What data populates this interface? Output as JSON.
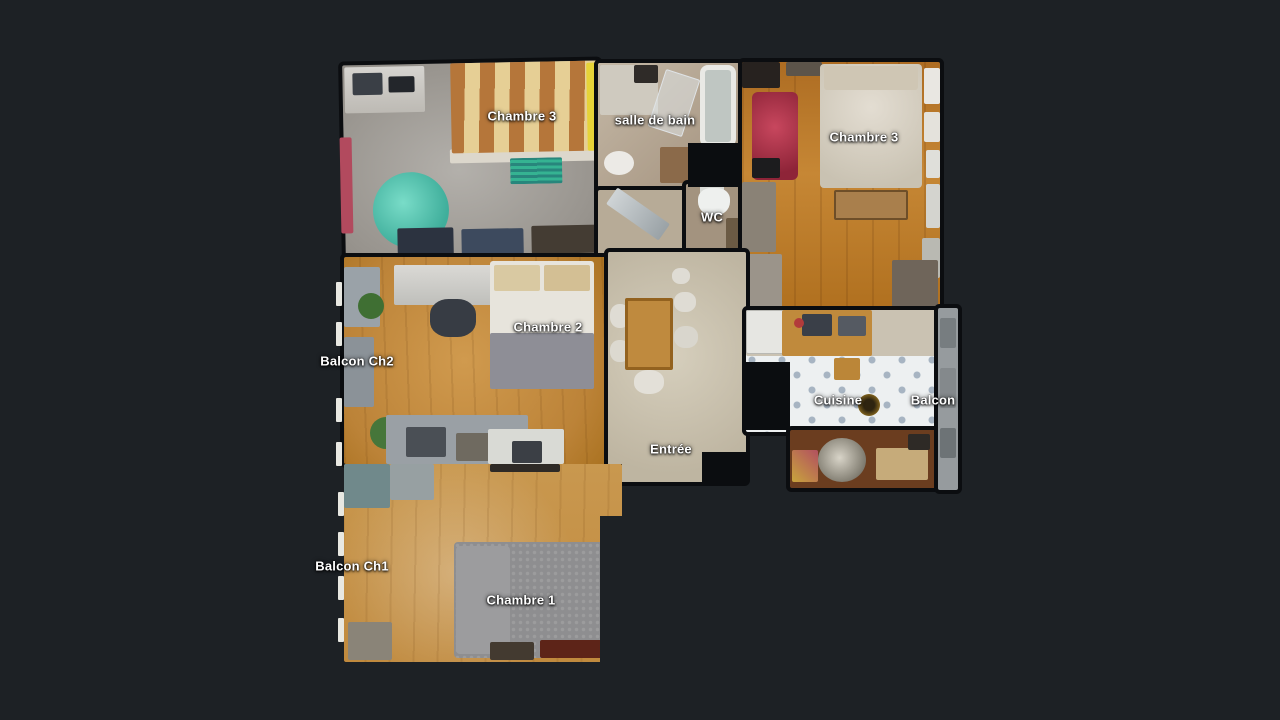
{
  "scene": {
    "kind": "apartment-floorplan-top-view",
    "background": "#1d2125"
  },
  "palette": {
    "background": "#1d2125",
    "label_text": "#ffffff",
    "wood_floor": "#c08136",
    "grey_floor": "#9b9894",
    "tile_floor": "#edf0f1",
    "hall_floor": "#cec6b4",
    "accent_teal": "#4ecdb4",
    "wall": "#0b0d10"
  },
  "rooms": [
    {
      "id": "chambre3-left",
      "label": "Chambre 3"
    },
    {
      "id": "salle-de-bain",
      "label": "salle de bain"
    },
    {
      "id": "chambre3-right",
      "label": "Chambre 3"
    },
    {
      "id": "wc",
      "label": "WC"
    },
    {
      "id": "chambre2",
      "label": "Chambre 2"
    },
    {
      "id": "balcon-ch2",
      "label": "Balcon Ch2"
    },
    {
      "id": "cuisine",
      "label": "Cuisine"
    },
    {
      "id": "balcon",
      "label": "Balcon"
    },
    {
      "id": "entree",
      "label": "Entrée"
    },
    {
      "id": "balcon-ch1",
      "label": "Balcon Ch1"
    },
    {
      "id": "chambre1",
      "label": "Chambre 1"
    }
  ]
}
